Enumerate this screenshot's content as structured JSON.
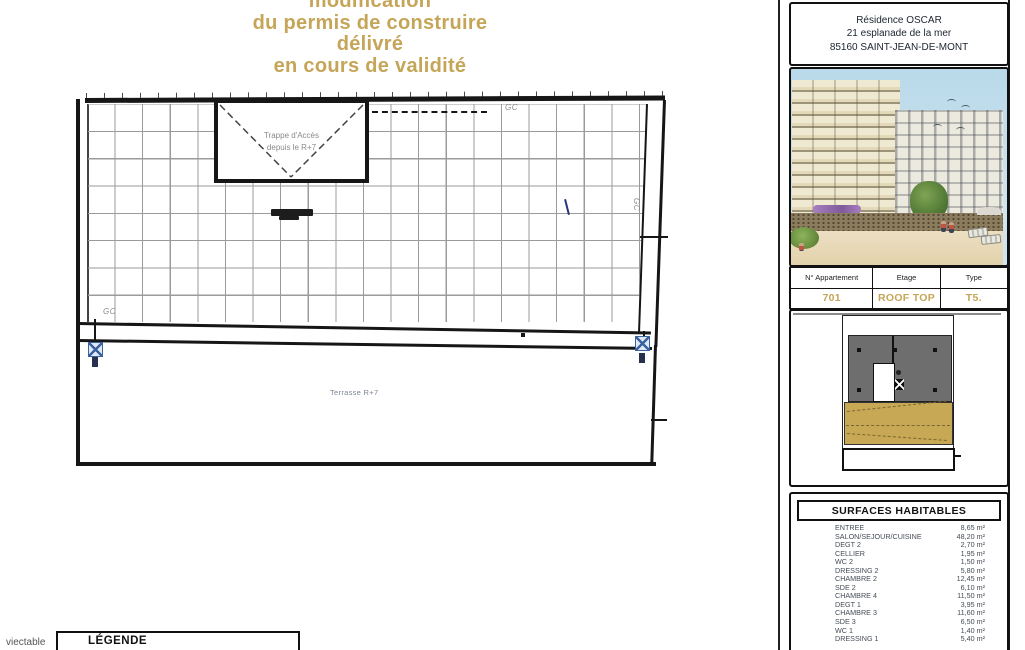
{
  "colors": {
    "accent_gold": "#c5a557",
    "terrace_gold": "#c7a855"
  },
  "title_block": {
    "lines": [
      "modification",
      "du permis de construire",
      "délivré",
      "en cours de validité"
    ]
  },
  "plan": {
    "hatch_label": {
      "line1": "Trappe d'Accès",
      "line2": "depuis le R+7"
    },
    "terrace_label": "Terrasse R+7",
    "gc_label": "GC"
  },
  "legend": {
    "title": "LÉGENDE",
    "partial_text": "viectable"
  },
  "right_panel": {
    "address": {
      "line1": "Résidence OSCAR",
      "line2": "21 esplanade de la mer",
      "line3": "85160 SAINT-JEAN-DE-MONT"
    },
    "apartment": {
      "headers": [
        "N° Appartement",
        "Etage",
        "Type"
      ],
      "number": "701",
      "floor": "ROOF TOP",
      "type": "T5."
    },
    "surfaces": {
      "title": "SURFACES HABITABLES",
      "rows": [
        {
          "name": "ENTREE",
          "area": "8,65 m²"
        },
        {
          "name": "SALON/SEJOUR/CUISINE",
          "area": "48,20 m²"
        },
        {
          "name": "DEGT 2",
          "area": "2,70 m²"
        },
        {
          "name": "CELLIER",
          "area": "1,95 m²"
        },
        {
          "name": "WC 2",
          "area": "1,50 m²"
        },
        {
          "name": "DRESSING 2",
          "area": "5,80 m²"
        },
        {
          "name": "CHAMBRE 2",
          "area": "12,45 m²"
        },
        {
          "name": "SDE 2",
          "area": "6,10 m²"
        },
        {
          "name": "CHAMBRE 4",
          "area": "11,50 m²"
        },
        {
          "name": "DEGT 1",
          "area": "3,95 m²"
        },
        {
          "name": "CHAMBRE 3",
          "area": "11,60 m²"
        },
        {
          "name": "SDE 3",
          "area": "6,50 m²"
        },
        {
          "name": "WC 1",
          "area": "1,40 m²"
        },
        {
          "name": "DRESSING 1",
          "area": "5,40 m²"
        }
      ]
    }
  }
}
